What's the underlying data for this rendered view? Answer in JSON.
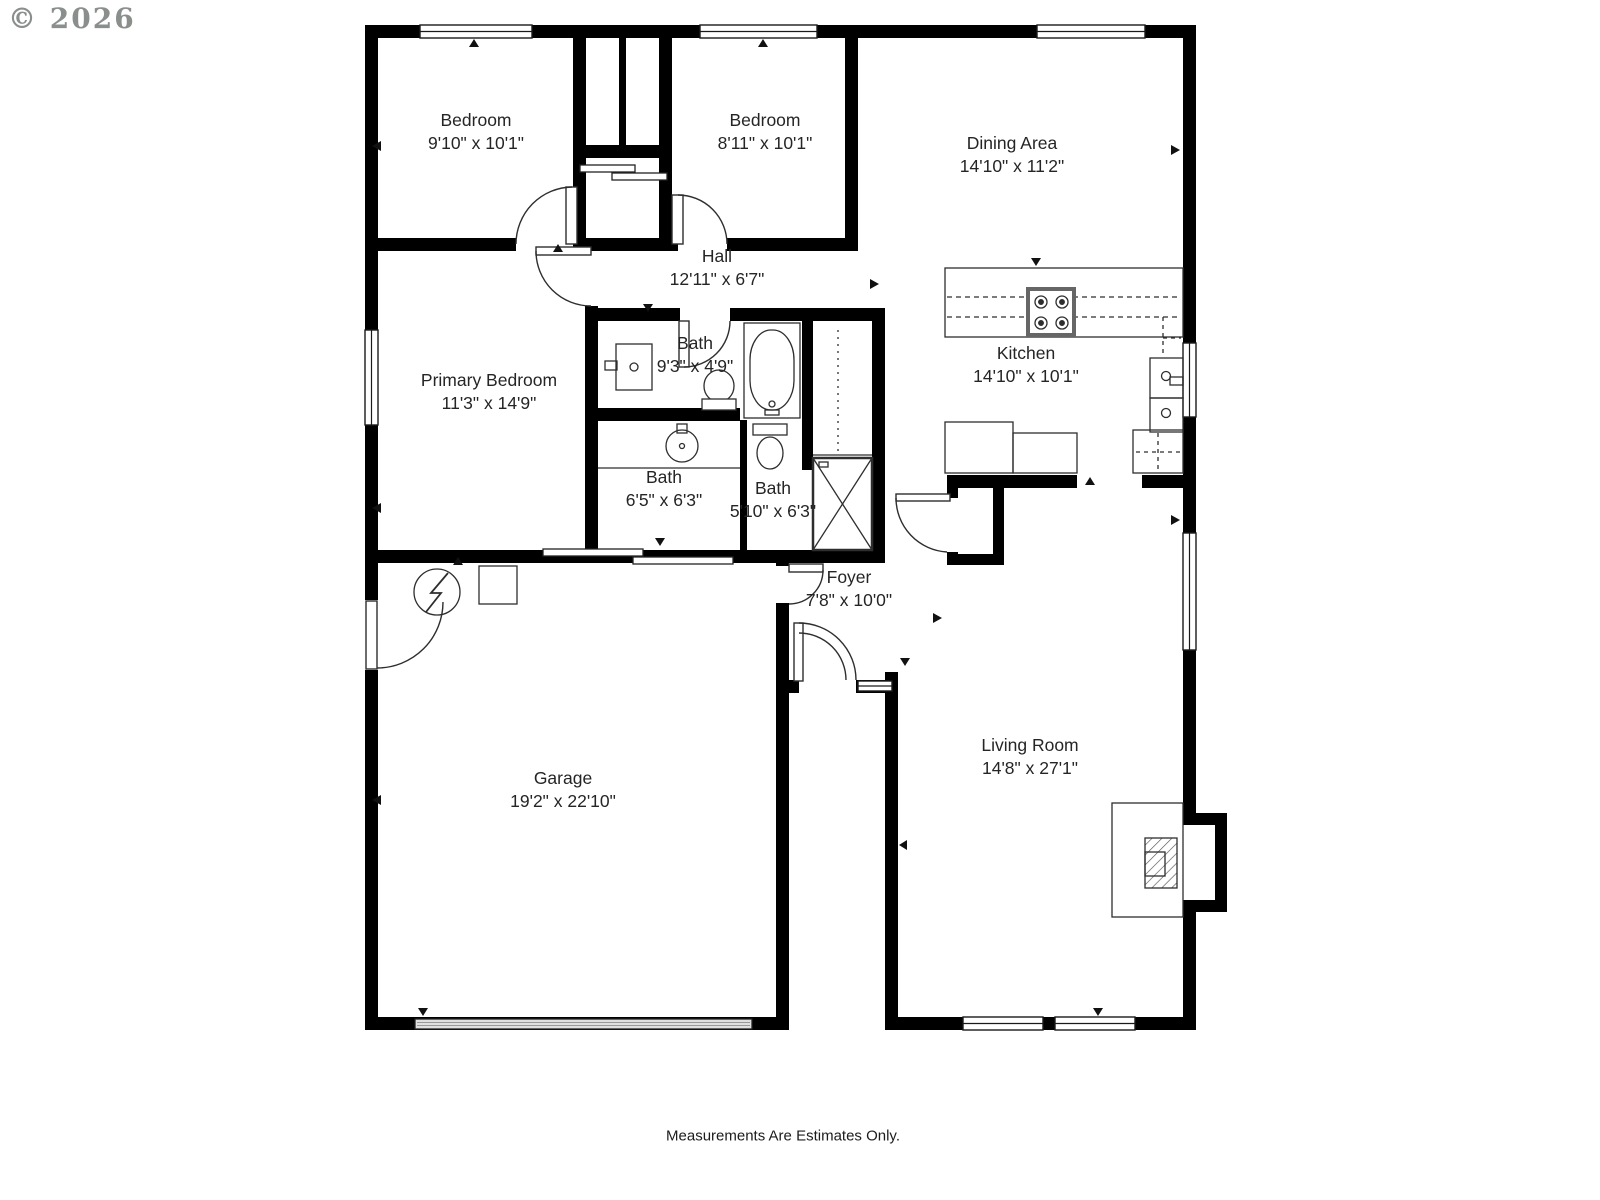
{
  "watermark": {
    "text": "© 2026"
  },
  "footer": {
    "text": "Measurements Are Estimates Only."
  },
  "colors": {
    "wall": "#000000",
    "label_text": "#252525",
    "watermark": "#8a8f8c",
    "fixture_line": "#2e2e2e",
    "garage_door_fill": "#e0e0e0"
  },
  "rooms": [
    {
      "id": "bedroom-1",
      "name": "Bedroom",
      "dims": "9'10\" x 10'1\""
    },
    {
      "id": "bedroom-2",
      "name": "Bedroom",
      "dims": "8'11\" x 10'1\""
    },
    {
      "id": "dining",
      "name": "Dining Area",
      "dims": "14'10\" x 11'2\""
    },
    {
      "id": "hall",
      "name": "Hall",
      "dims": "12'11\" x 6'7\""
    },
    {
      "id": "bath-upper",
      "name": "Bath",
      "dims": "9'3\" x 4'9\""
    },
    {
      "id": "primary",
      "name": "Primary Bedroom",
      "dims": "11'3\" x 14'9\""
    },
    {
      "id": "kitchen",
      "name": "Kitchen",
      "dims": "14'10\" x 10'1\""
    },
    {
      "id": "bath-mid",
      "name": "Bath",
      "dims": "6'5\" x 6'3\""
    },
    {
      "id": "bath-low",
      "name": "Bath",
      "dims": "5'10\" x 6'3\""
    },
    {
      "id": "foyer",
      "name": "Foyer",
      "dims": "7'8\" x 10'0\""
    },
    {
      "id": "garage",
      "name": "Garage",
      "dims": "19'2\" x 22'10\""
    },
    {
      "id": "living",
      "name": "Living Room",
      "dims": "14'8\" x 27'1\""
    }
  ]
}
